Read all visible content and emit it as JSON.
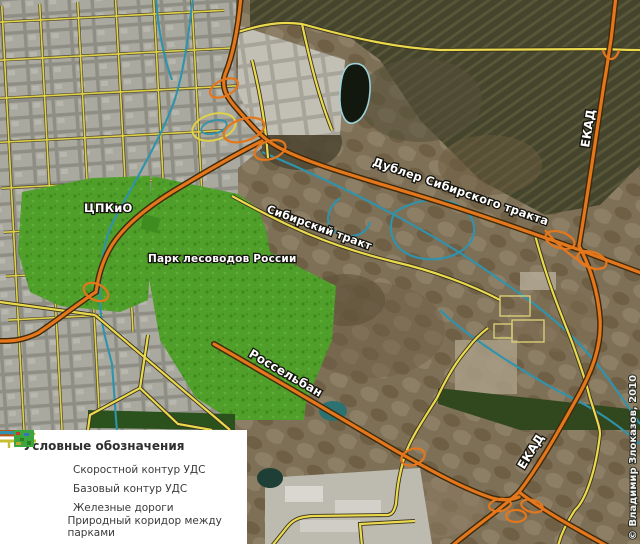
{
  "map": {
    "labels": {
      "cpkio": "ЦПКиО",
      "park_lesovodov": "Парк лесоводов России",
      "sibirsky_trakt": "Сибирский тракт",
      "dubler": "Дублер Сибирского тракта",
      "rosselban": "Россельбан",
      "ekad_north": "ЕКАД",
      "ekad_south": "ЕКАД"
    },
    "copyright": "© Владимир Злоказов, 2010"
  },
  "legend": {
    "title": "Условные обозначения",
    "items": [
      {
        "id": "speed-contour",
        "label": "Скоростной контур УДС",
        "color": "#c05a16"
      },
      {
        "id": "base-contour",
        "label": "Базовый контур УДС",
        "color": "#c6bf33"
      },
      {
        "id": "railways",
        "label": "Железные дороги",
        "color": "#2f93ad"
      },
      {
        "id": "nature-corridor",
        "label": "Природный коридор между парками",
        "color": "#3da53d"
      }
    ]
  },
  "colors": {
    "speed_road": "#e4771c",
    "speed_road_casing": "#3f2a0c",
    "base_road": "#ebda4d",
    "railway": "#2f93ad",
    "park_green": "#4f9f2a",
    "forest_dark": "#45442c",
    "urban_gray": "#a9a9a0",
    "legend_bg": "#ffffff"
  }
}
